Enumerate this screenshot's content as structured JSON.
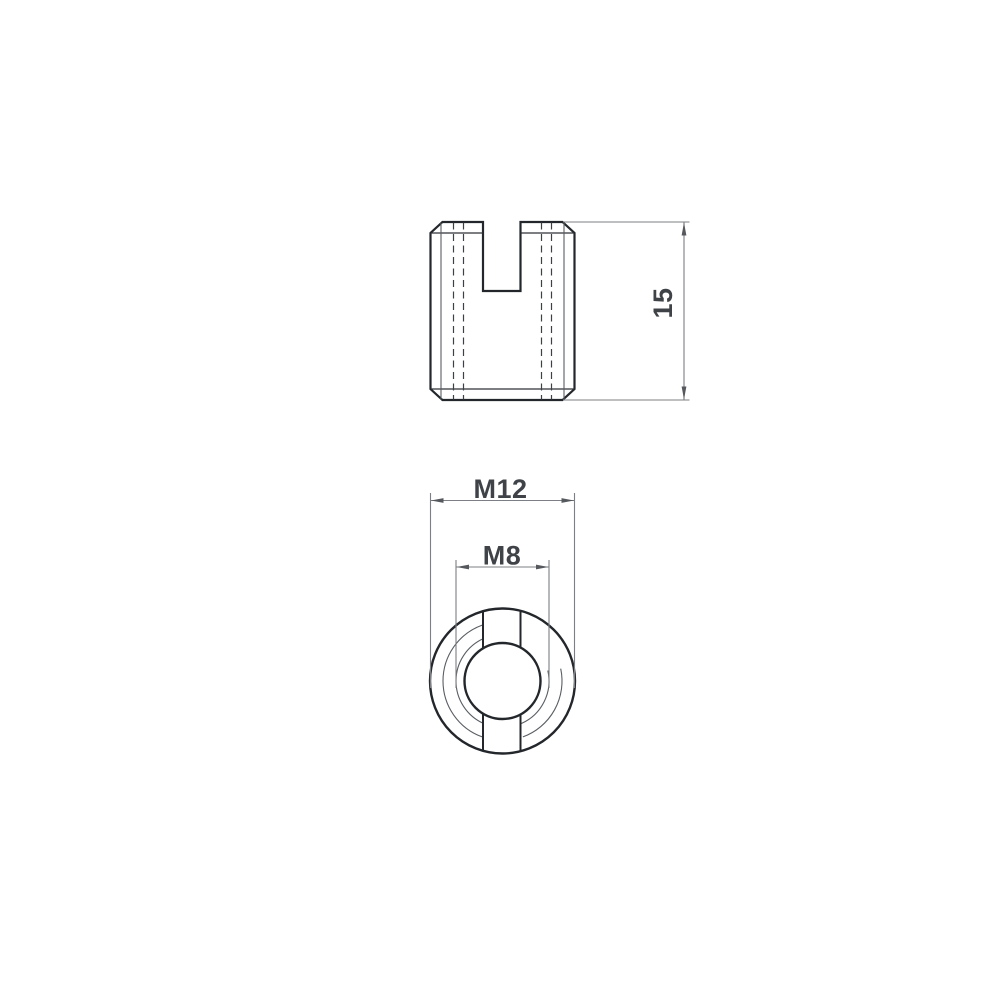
{
  "colors": {
    "bg": "#ffffff",
    "line-bold": "#23272b",
    "line-medium": "#2e3236",
    "line-thin": "#595e63",
    "line-hidden": "#3d4145",
    "dim-line": "#7c7f83",
    "dim-arrow": "#55585c",
    "dim-text": "#3f4347"
  },
  "dims": {
    "height": {
      "label": "15"
    },
    "outer": {
      "label": "M12"
    },
    "inner": {
      "label": "M8"
    }
  }
}
